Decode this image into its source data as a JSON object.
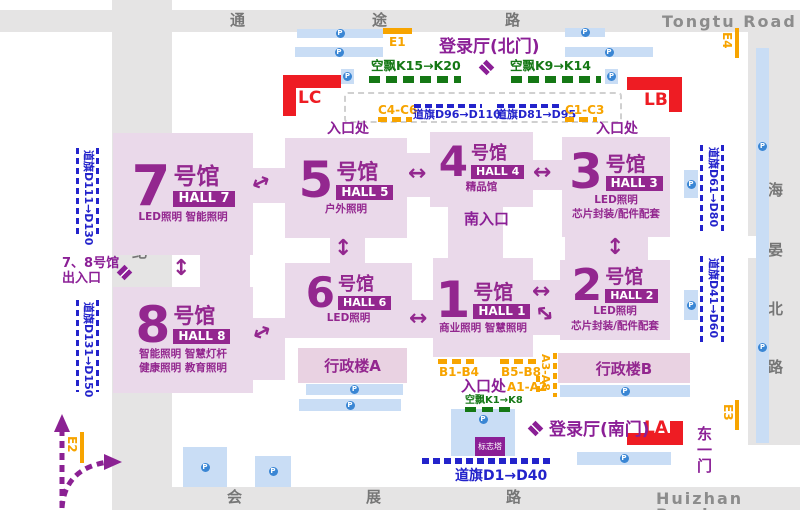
{
  "roads": {
    "top": {
      "chars": [
        "通",
        "途",
        "路"
      ],
      "en": "Tongtu Road"
    },
    "bottom": {
      "chars": [
        "会",
        "展",
        "路"
      ],
      "en": "Huizhan Road"
    },
    "left": {
      "chars": [
        "世",
        "纪",
        "大",
        "道"
      ]
    },
    "right": {
      "chars": [
        "海",
        "晏",
        "北",
        "路"
      ]
    }
  },
  "halls": {
    "h7": {
      "num": "7",
      "suffix": "号馆",
      "badge": "HALL 7",
      "line1": "LED照明  智能照明"
    },
    "h5": {
      "num": "5",
      "suffix": "号馆",
      "badge": "HALL 5",
      "line1": "户外照明"
    },
    "h4": {
      "num": "4",
      "suffix": "号馆",
      "badge": "HALL 4",
      "line1": "精品馆"
    },
    "h3": {
      "num": "3",
      "suffix": "号馆",
      "badge": "HALL 3",
      "line1": "LED照明",
      "line2": "芯片封装/配件配套"
    },
    "h8": {
      "num": "8",
      "suffix": "号馆",
      "badge": "HALL 8",
      "line1": "智能照明  智慧灯杆",
      "line2": "健康照明  教育照明"
    },
    "h6": {
      "num": "6",
      "suffix": "号馆",
      "badge": "HALL 6",
      "line1": "LED照明"
    },
    "h1": {
      "num": "1",
      "suffix": "号馆",
      "badge": "HALL 1",
      "line1": "商业照明  智慧照明"
    },
    "h2": {
      "num": "2",
      "suffix": "号馆",
      "badge": "HALL 2",
      "line1": "LED照明",
      "line2": "芯片封装/配件配套"
    }
  },
  "buildings": {
    "a": "行政楼A",
    "b": "行政楼B"
  },
  "gates": {
    "lc": "LC",
    "lb": "LB",
    "la": "LA"
  },
  "labels": {
    "north_lobby": "登录厅(北门)",
    "south_lobby": "登录厅(南门)",
    "entrance": "入口处",
    "south_entrance": "南入口",
    "halls78_1": "7、8号馆",
    "halls78_2": "出入口",
    "east_gate_chars": [
      "东",
      "一",
      "门"
    ],
    "tower": "标志塔"
  },
  "balloons": {
    "k15": "空飘K15→K20",
    "k9": "空飘K9→K14",
    "k1": "空飘K1→K8"
  },
  "flags": {
    "d96": "道旗D96→D110",
    "d81": "道旗D81→D95",
    "d111": "道旗D111→D130",
    "d131": "道旗D131→D150",
    "d61": "道旗D61→D80",
    "d41": "道旗D41→D60",
    "d1": "道旗D1→D40"
  },
  "zones": {
    "c46": "C4-C6",
    "c13": "C1-C3",
    "b14": "B1-B4",
    "b58": "B5-B8",
    "a12": "A1-A2",
    "a38": "A3-A8"
  },
  "e_gates": {
    "e1": "E1",
    "e2": "E2",
    "e3": "E3",
    "e4": "E4"
  },
  "parking": {
    "label": "P"
  },
  "colors": {
    "hall_fill": "#ead9ea",
    "hall_purple": "#93278f",
    "label_purple": "#8b1f96",
    "gate_red": "#ee1c23",
    "balloon_green": "#157815",
    "flag_blue": "#2323cb",
    "zone_orange": "#f7a400",
    "parking_bar": "#c9ddf5",
    "parking_blue": "#3a86d4",
    "road_gray": "#e5e4e4"
  }
}
